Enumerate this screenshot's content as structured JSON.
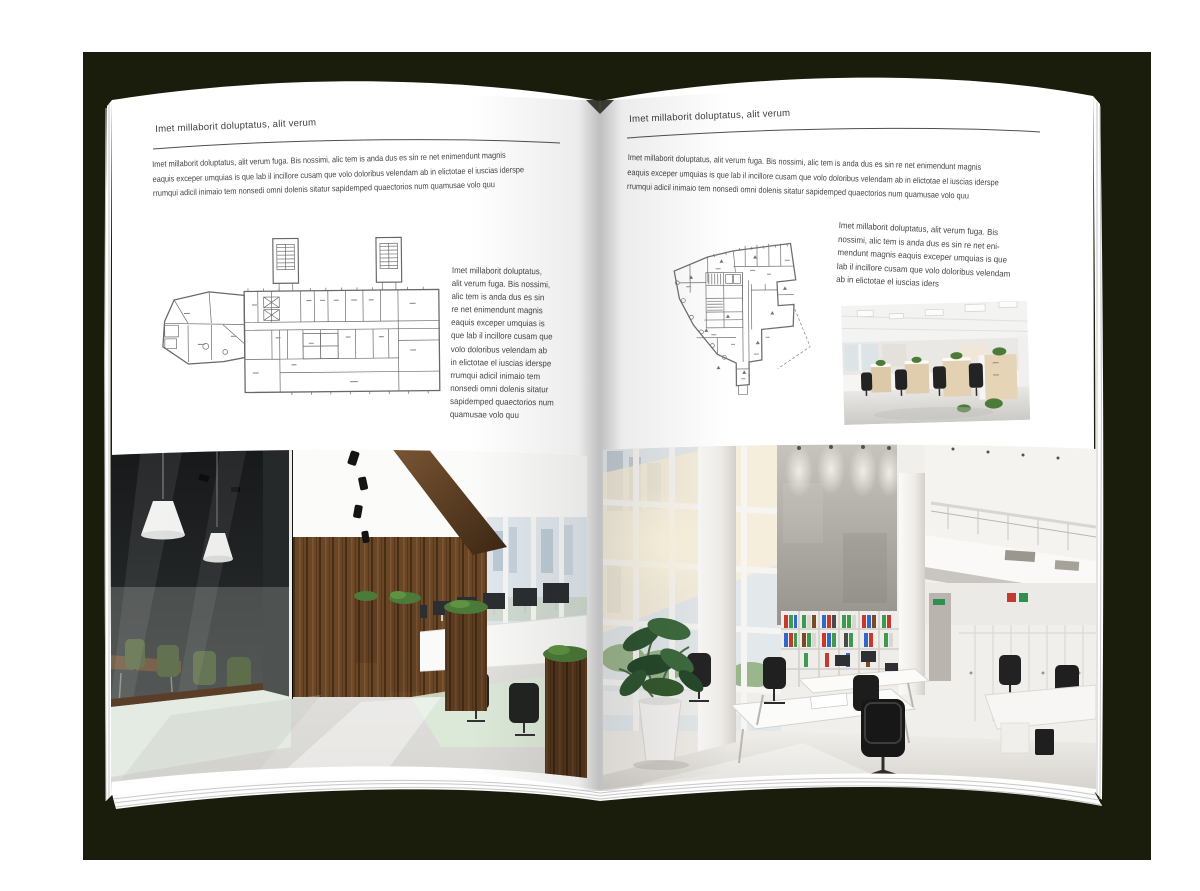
{
  "mockup": {
    "description_label": "open-magazine-spread-mockup",
    "colors": {
      "backdrop": "#1a1c0c",
      "page": "#ffffff",
      "text": "#3d3d3d",
      "rule": "#4f4f4f",
      "wood_accent": "#6b4a2e",
      "plant_green": "#3c6b3e"
    }
  },
  "left_page": {
    "header": "Imet millaborit doluptatus, alit verum",
    "intro_lines": [
      "Imet millaborit doluptatus, alit verum fuga. Bis nossimi, alic tem is anda dus es sin re net enimendunt magnis",
      "eaquis exceper umquias is que lab il incillore cusam que volo doloribus velendam ab in elictotae el iuscias iderspe",
      "rrumqui adicil inimaio tem nonsedi omni dolenis sitatur sapidemped quaectorios num quamusae volo quu"
    ],
    "side_text_lines": [
      "Imet millaborit doluptatus,",
      "alit verum fuga. Bis nossimi,",
      "alic tem is anda dus es sin",
      "re net enimendunt magnis",
      "eaquis exceper umquias is",
      "que lab il incillore cusam que",
      "volo doloribus velendam ab",
      "in elictotae el iuscias iderspe",
      "rrumqui adicil inimaio tem",
      "nonsedi omni dolenis sitatur",
      "sapidemped quaectorios num",
      "quamusae volo quu"
    ]
  },
  "right_page": {
    "header": "Imet millaborit doluptatus, alit verum",
    "intro_lines": [
      "Imet millaborit doluptatus, alit verum fuga. Bis nossimi, alic tem is anda dus es sin re net enimendunt magnis",
      "eaquis exceper umquias is que lab il incillore cusam que volo doloribus velendam ab in elictotae el iuscias iderspe",
      "rrumqui adicil inimaio tem nonsedi omni dolenis sitatur sapidemped quaectorios num quamusae volo quu"
    ],
    "side_text_lines": [
      "Imet millaborit doluptatus, alit verum fuga. Bis",
      "nossimi, alic tem is anda dus es sin re net eni-",
      "mendunt magnis eaquis exceper umquias is que",
      "lab il incillore cusam que volo doloribus velendam",
      "ab in elictotae el iuscias iders"
    ]
  }
}
